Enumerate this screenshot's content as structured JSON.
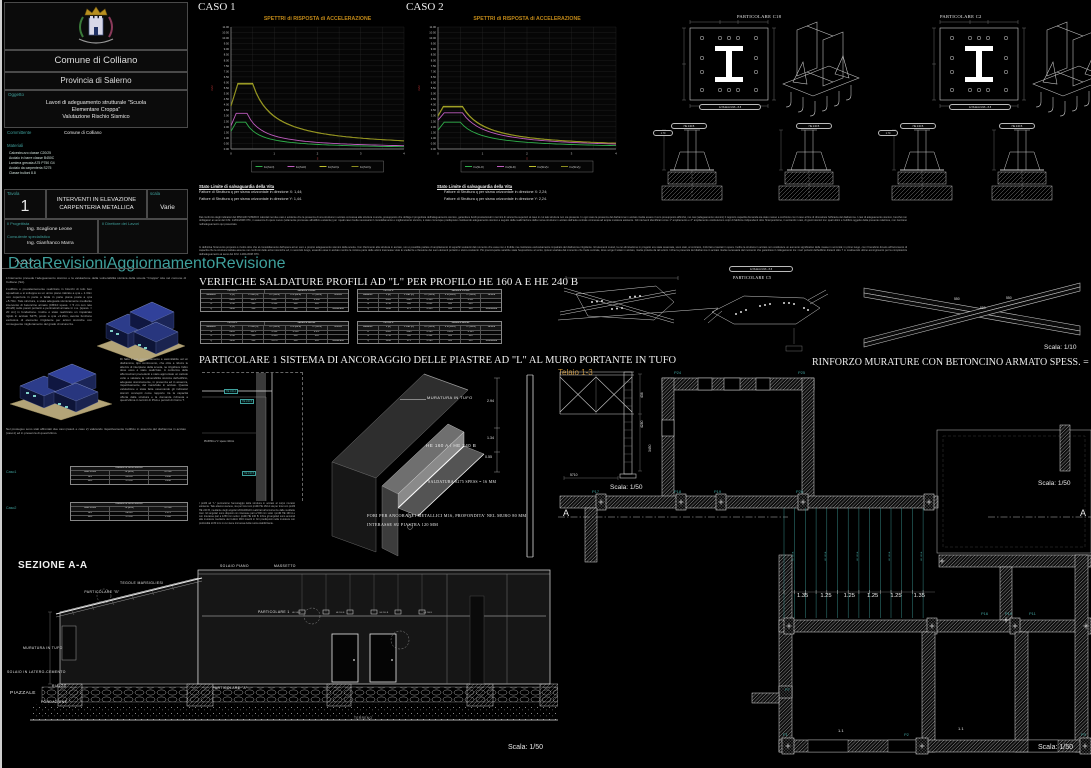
{
  "title_block": {
    "comune": "Comune di Colliano",
    "provincia": "Provincia di Salerno",
    "oggetto_label": "Oggetto",
    "oggetto_lines": [
      "Lavori di adeguamento strutturale \"Scuola",
      "Elementare Croppa\"",
      "Valutazione Rischio Sismico"
    ],
    "committente_label": "Committente",
    "committente": "Comune di Colliano",
    "materiali_label": "Materiali",
    "materiali": [
      "Calcestruzzo classe C20/25",
      "Acciaio in barre classe B450C",
      "Lamiera grecata A75 P750 G4",
      "Acciaio da carpenteria S275",
      "Classe bulloni 8.8"
    ],
    "tavola_label": "Tavola",
    "tavola_numero": "1",
    "tavola_titolo": "INTERVENTI IN ELEVAZIONE CARPENTERIA METALLICA",
    "scala_label": "scala",
    "scala_valore": "Varie",
    "progettista_label": "Il Progettista",
    "progettista": "Ing. Scaglione Leone",
    "consulente_label": "Consulente specialistico",
    "consulente": "Ing. Gianfranco Marra",
    "direttore_label": "Il Direttore dei Lavori",
    "footer_labels": [
      "Data",
      "Revisioni",
      "Aggiornamento",
      "Revisione"
    ]
  },
  "left_column": {
    "p1": "L'intervento prevede l'adeguamento sismico e la valutazione della vulnerabilità sismica della scuola \"Croppa\" sita nel comune di Colliano (SA).",
    "p2": "L'edificio è prevalentemente realizzato in blocchi di tufo ben squadrato e si sviluppa su un unico piano rialzato a q.ta + 1.34m con copertura in parte a falda in parte piana posta a q.ta +5.70m. Tale struttura, è stata adeguata sismicamente mediante intervento di betoncino armato (CB/10 spess. = 5 cm con rete 20x20) sulle pareti portanti e perimetrali armate in c.a. [spess. = 20 cm] in fondazione. Inoltre è stato realizzato un impalcato rigido in acciaio S275, posto a q.ta +3.20m, avente funzione esclusiva di elemento irrigidente per azioni sismiche con conseguente miglioramento del grado di sicurezza.",
    "p3": "Di fatto il suo comportamento è assimilabile ad un diaframma, tipo controvento, che oltre a ridurre le altezze di interpiano della scuola, ne irrigidisce l'altro dove esso è stato realizzato. A conferma delle affermazioni precedenti è stato approntato un calcolo volto a valutare la vulnerabilità sismica dell'edificio, adeguato sismicamente, in presenza ed in assenza, rispettivamente, del manufatto in acciaio. Questa valutazione è stata fatta osservando gli indicatori sismici concepiti come rapporto tra la capacità offerta dalla struttura e la domanda richiesta a quest'ultima in termini di PGA e periodi di ritorno T.",
    "p4": "Nel prosieguo sono stati affrontati due casi (caso1 e caso 2) valutando rispettivamente l'edificio in assenza del diaframma in acciaio (caso1) ed in presenza di quest'ultimo.",
    "risk1": {
      "label": "Caso1",
      "title": "Indicatori di rischio sismico",
      "header": [
        "Stato Limite",
        "TR [anni]",
        "α PGA"
      ],
      "rows": [
        [
          "SLV",
          "23.856",
          "0.846"
        ],
        [
          "SLD",
          "37.059",
          "0.938"
        ]
      ]
    },
    "risk2": {
      "label": "Caso2",
      "title": "Indicatori di rischio sismico",
      "header": [
        "Stato Limite",
        "TR [anni]",
        "α PGA"
      ],
      "rows": [
        [
          "SLV",
          "29.085",
          "1.075"
        ],
        [
          "SLD",
          "37.059",
          "1.308"
        ]
      ]
    }
  },
  "chart_data": [
    {
      "type": "line",
      "name": "CASO 1",
      "title": "SPETTRI di RISPOSTA di ACCELERAZIONE",
      "ylabel": "m/s²",
      "xlabel": "s",
      "ylim": [
        0,
        11
      ],
      "ystep": 0.5,
      "xlim": [
        0,
        4
      ],
      "legend_position": "bottom",
      "series": [
        {
          "name": "Fo(SLO)",
          "color": "#2fae4a",
          "a0": 1.6,
          "tb": 0.12,
          "tc": 0.34,
          "peak": 2.42
        },
        {
          "name": "Fo(SLD)",
          "color": "#bf5cbf",
          "a0": 2.1,
          "tb": 0.12,
          "tc": 0.37,
          "peak": 3.22
        },
        {
          "name": "Fo(SLV)x",
          "color": "#bdbd2e",
          "a0": 3.9,
          "tb": 0.16,
          "tc": 0.5,
          "peak": 5.92
        },
        {
          "name": "Fo(SLV)y",
          "color": "#8c8c1e",
          "a0": 3.85,
          "tb": 0.16,
          "tc": 0.5,
          "peak": 5.84
        }
      ]
    },
    {
      "type": "line",
      "name": "CASO 2",
      "title": "SPETTRI di RISPOSTA di ACCELERAZIONE",
      "ylabel": "m/s²",
      "xlabel": "s",
      "ylim": [
        0,
        11
      ],
      "ystep": 0.5,
      "xlim": [
        0,
        4
      ],
      "legend_position": "bottom",
      "series": [
        {
          "name": "Fo(SLO)",
          "color": "#2fae4a",
          "a0": 1.7,
          "tb": 0.14,
          "tc": 0.5,
          "peak": 2.42
        },
        {
          "name": "Fo(SLD)",
          "color": "#bf5cbf",
          "a0": 2.6,
          "tb": 0.14,
          "tc": 0.55,
          "peak": 3.26
        },
        {
          "name": "Fo(SLV)x",
          "color": "#bdbd2e",
          "a0": 3.0,
          "tb": 0.12,
          "tc": 0.55,
          "peak": 3.85
        },
        {
          "name": "Fo(SLV)y",
          "color": "#8c8c1e",
          "a0": 2.95,
          "tb": 0.12,
          "tc": 0.55,
          "peak": 3.78
        }
      ]
    }
  ],
  "spectra_notes": {
    "note_title": "Stato Limite di salvaguardia della Vita",
    "caso1_lines": [
      "Fattore di Struttura q per sisma orizzontale in direzione X: 1,44;",
      "Fattore di Struttura q per sisma orizzontale in direzione Y: 1,44."
    ],
    "caso2_lines": [
      "Fattore di Struttura q per sisma orizzontale in direzione X: 2,24;",
      "Fattore di Struttura q per sisma orizzontale in direzione Y: 2,24."
    ]
  },
  "center_text": {
    "block1": "Dal confronto degli indicatori del RISCHIO SISMICO calcolati nei due casi è evidente che la presenza di una struttura in acciaio connessa alla struttura muraria, presupposto che obbliga il progettista dell'adeguamento sismico, garantisce livelli prestazionali in termini di sicurezza superiori al caso in cui tale struttura non sia presente. In ogni caso la presenza del diaframma in acciaio risulta essere il vero presupposto affinché, nei casi (adeguamento sismico) il rapporto capacità domanda sia stato messo a confronto con il caso al fine di dimostrare l'efficacia del diaframma. I casi di adeguamento sismico, benché non obbligatori ai sensi del D.M. 14/01/2008 NTC, in assenza di opere nuove (solamente premesse all'edificio esistente) per i quali caso risulta necessario il consolidamento e miglioramento sismico, è stato comunque predisposto costituendo adeguamento sismico a seguito della realizzazione della nuova struttura in acciaio dell'aula centrale connessa ad ampia muratura esistente. Gli interventi identificati come 1° ampliamento e 2° ampliamento costituiscono corpi di fabbrica indipendenti oltre l'interposizione, in entrambi i casi, di giunti sismici tra i quali ultimi e l'edificio oggetto della presente relazione, non rientrano nell'adeguamento qui presentato.",
    "block2": "In definitiva l'intervento proposto è rivolto oltre che al consolidamento dell'opera ad un vero e proprio adeguamento sismico della scuola. Con riferimento alla struttura in acciaio, non è possibile parlare di ampliamento di superfici esistenti dal momento che essa non è fruibile ma costituisce esclusivamente impalcato del diaframma irrigidente. Gli elementi murari, la cui eliminazione in progetto era stata osservata, sono stati, al contrario, rinforzati e lasciati in opera. Inoltre la struttura in acciaio non costituisce un aumento significativo delle masse in sommità; in primo luogo, con il beneficio dovuto all'incremento di capacità che la struttura trattata assume nei confronti delle azioni sismiche ed, in secondo luogo, essendo essa in acciaio mentre la minima parte delle azioni trasmesse viste le snellezze e flessione dei suoi elementi portanti e sismo-resistenti. Più preoccupante sarebbe stata l'esposizione al vento, ipotesi scartata dal momento che l'aula centrale, dove sorge il telaio in acciaio, risulta protetta da tali azioni. Infine la presenza del diaframma in acciaio risulta necessaria dal momento che garantisce il collegamento tra i muri portanti dell'edificio distanti oltre 7 m costituendo ultimo accorgimento per la completezza dell'adeguamento ai sensi del D.M. 14/01/2008 NTC."
  },
  "welds": {
    "heading": "VERIFICHE SALDATURE PROFILI AD \"L\" PER PROFILO HE 160 A E HE 240 B",
    "header": [
      "saldature",
      "F [N]",
      "F max [N]",
      "σ⊥ [MPa]",
      "σ id [MPa]",
      "τ⊥ [MPa]",
      "Verifica"
    ],
    "tables": [
      {
        "profile": "HE 160 A",
        "weld": "Saldatura frontale",
        "rows": [
          [
            "N",
            "8983",
            "141.1",
            "0.257",
            "0.404",
            "0.196",
            ""
          ],
          [
            "Tx",
            "1790",
            "466",
            "0.532",
            "400",
            "405",
            ""
          ],
          [
            "Ty",
            "3296",
            "540",
            "1.11",
            "400",
            "405",
            "Soddisfatta"
          ]
        ]
      },
      {
        "profile": "HE 240 B",
        "weld": "Saldatura frontale",
        "rows": [
          [
            "N",
            "8465",
            "1496",
            "0.146",
            "0.528",
            "0.067",
            ""
          ],
          [
            "Tx",
            "2730",
            "580",
            "0.651",
            "400",
            "405",
            ""
          ],
          [
            "Ty",
            "5296",
            "475",
            "0.953",
            "400",
            "405",
            "Soddisfatta"
          ]
        ]
      },
      {
        "profile": "HE 160 A",
        "weld": "Saldatura laterale",
        "rows": [
          [
            "N",
            "8983",
            "141.1",
            "0.532",
            "0.510",
            "0.257",
            ""
          ],
          [
            "Tx",
            "1790",
            "466",
            "0.438",
            "400",
            "405",
            ""
          ],
          [
            "Ty",
            "3296",
            "540",
            "0.876",
            "400",
            "405",
            "Soddisfatta"
          ]
        ]
      },
      {
        "profile": "HE 240 B",
        "weld": "Saldatura laterale",
        "rows": [
          [
            "N",
            "8465",
            "1496",
            "0.583",
            "0.285",
            "0.125",
            ""
          ],
          [
            "Tx",
            "2730",
            "580",
            "0.402",
            "400",
            "405",
            ""
          ],
          [
            "Ty",
            "5296",
            "475",
            "0.593",
            "400",
            "405",
            "Soddisfatta"
          ]
        ]
      }
    ]
  },
  "particolare1": {
    "heading": "PARTICOLARE 1 SISTEMA DI ANCORAGGIO DELLE PIASTRE AD \"L\" AL  MURO PORTANTE IN TUFO",
    "muratura": "MURATURA IN TUFO",
    "profili": "HE 160 A / HE 240 B",
    "saldatura": "SALDATURA S275 SPESS = 16 MM",
    "fori": "FORI PER ANCORANTI METALLICI M16, PROFONDITA' NEL MURO 80 MM",
    "interasse": "INTERASSE SU PIASTRA 120 MM",
    "chip1": "HE 160 A",
    "chip2": "HE 240 B",
    "chip3": "HE 240 B",
    "piastra": "PIASTRA a \"L\" spess.=10mm",
    "note": "I profili ad \"L\" permettono l'ancoraggio della struttura in acciaio al corpo murario esistente. Tale attacco avviene, sia per travi con profili HE 160 A sia per travi con profili HE 240 B, mediante degli angolari 200x200x16 realizzati all'occorrenza dalle suddette travi. Gli angolari sono disposti con interasse pari a 500 mm sotto i profili HE 160 A e con interasse pari a 1250 mm sotto i profili HE 240 B. Infine gli angolari sono ancorati alla muratura mediante dei bulloni M16 inseriti in fori predisposti nella muratura con profondità di 80 mm in cui viene immessa della resina stabilizzante.",
    "dims": [
      "2.94",
      "1.34",
      "0.55"
    ]
  },
  "telaio": {
    "label": "Telaio 1-3",
    "dim_436": "436",
    "dim_4280": "4280",
    "dim_3450": "3450",
    "dim_5710": "5710",
    "scala": "Scala: 1/50"
  },
  "rinforzo": {
    "heading": "RINFORZO MURATURE CON BETONCINO ARMATO SPESS. = 5 CM",
    "scala": "Scala: 1/50"
  },
  "dettagli": {
    "c18": "PARTICOLARE C18",
    "c2": "PARTICOLARE C2",
    "c5": "PARTICOLARE C5",
    "bolt_pill": "12 Bulloni M16 - 8.8",
    "elev_pill": "HE 240 B",
    "len_pill": "1.70",
    "brace_dims": [
      "550",
      "550",
      "550"
    ],
    "scala": "Scala: 1/10"
  },
  "plan": {
    "nodes": {
      "p1": "P1",
      "p2": "P2",
      "p3": "P3",
      "p7": "P7",
      "p10": "P10",
      "p11": "P11",
      "p16": "P16",
      "p17": "P17",
      "p18": "P18",
      "p19": "P19",
      "p20": "P20",
      "p24": "P24",
      "p25": "P25"
    },
    "dims": [
      "1.35",
      "1.25",
      "1.25",
      "1.25",
      "1.25",
      "1.35"
    ],
    "room_dim1": "1.1",
    "room_dim2": "1.1",
    "marker_a": "A",
    "joist_label": "HE 160 A",
    "scala": "Scala: 1/50"
  },
  "sezione": {
    "heading": "SEZIONE A-A",
    "labels": {
      "solaio_piano": "SOLAIO PIANO",
      "massetto": "MASSETTO",
      "tegole": "TEGOLE MARSIGLIESI",
      "part_b": "PARTICOLARE \"B\"",
      "muratura": "MURATURA IN TUFO",
      "solaio_lc": "SOLAIO IN LATERO-CEMENTO",
      "rialzo": "RIALZO",
      "piazzale": "PIAZZALE",
      "fondazione": "FONDAZIONE",
      "part_a": "PARTICOLARE \"A\"",
      "part_1": "PARTICOLARE 1",
      "terreno": "TERRENO"
    },
    "beam_labels": [
      "HE 240 B",
      "HE 240 B",
      "HE 240 B",
      "HE 240 B"
    ],
    "scala": "Scala: 1/50"
  }
}
